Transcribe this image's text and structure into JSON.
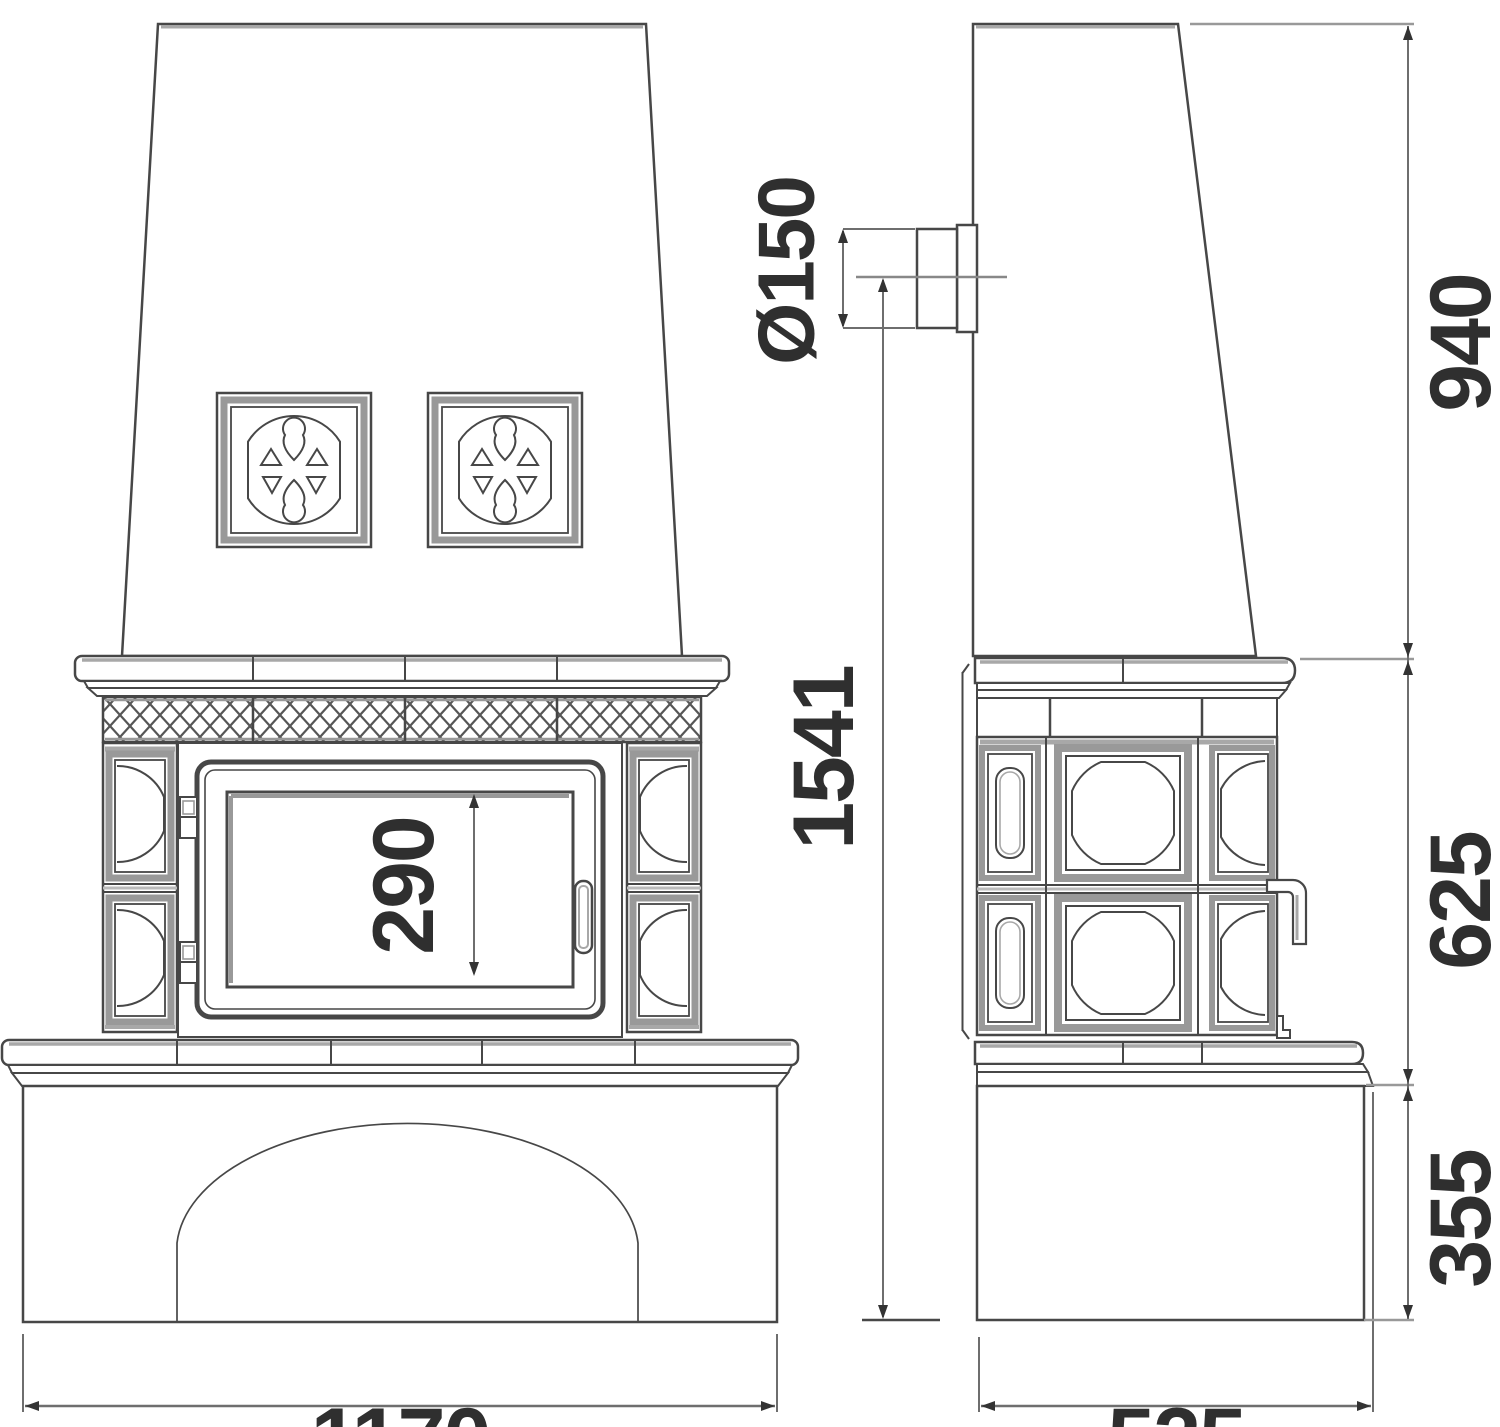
{
  "dimensions": {
    "flue_diameter": "Ø150",
    "height_to_flue_center": "1541",
    "upper_section_height": "940",
    "body_section_height": "625",
    "base_section_height": "355",
    "door_opening_height": "290",
    "overall_width": "1170",
    "overall_depth": "525"
  },
  "colors": {
    "line": "#474747",
    "shade": "#a8a8a8",
    "dimension": "#6e6e6e",
    "text": "#2f2f2f",
    "background": "#ffffff"
  }
}
